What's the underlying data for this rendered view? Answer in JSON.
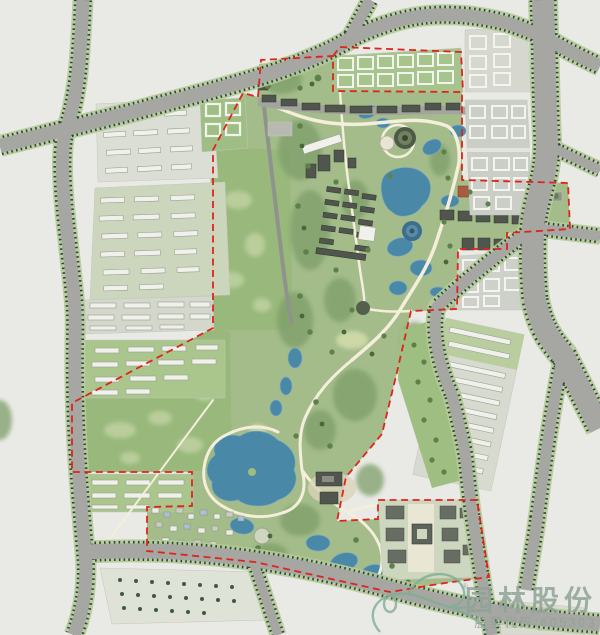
{
  "watermark": {
    "company": "园林股份",
    "stock_line": "股票代码:605303",
    "registered_mark": "®"
  },
  "palette": {
    "background": "#e9eae5",
    "road_gray": "#a6a7a3",
    "tree_line": "#2f4537",
    "verge_green": "#b5ca9a",
    "park_green": "#a3bc8a",
    "field_green": "#98b97b",
    "field_blotch": "#b9ce9b",
    "woods_green": "#7e9e69",
    "water_blue": "#4a88a8",
    "path_cream": "#f4eeda",
    "boundary_red": "#e0241a",
    "building_dark": "#50564e",
    "building_light": "#f0f1ea",
    "roof_red": "#a85a42",
    "watermark_green": "#8fa396"
  }
}
